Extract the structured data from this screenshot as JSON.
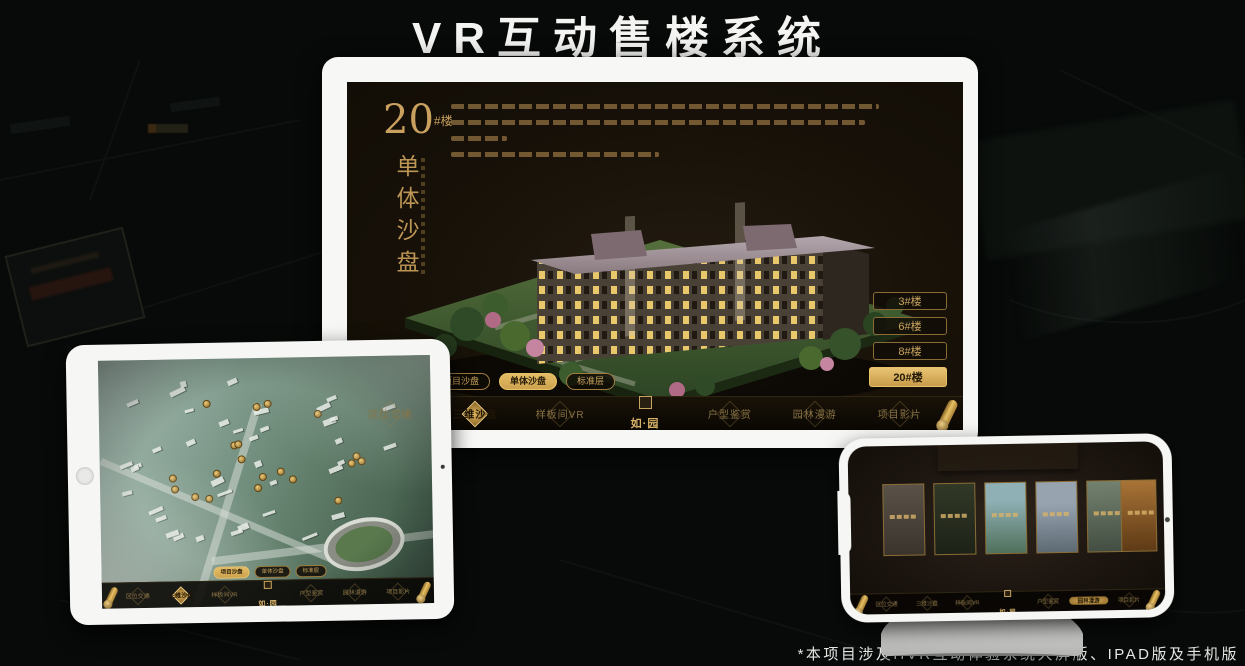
{
  "page": {
    "title": "VR互动售楼系统",
    "footnote": "*本项目涉及HVR互动体验系统大屏版、IPAD版及手机版"
  },
  "brand": {
    "name": "如·园"
  },
  "colors": {
    "gold": "#c9a45e",
    "gold_bright": "#e8c266",
    "screen_bg": "#171108",
    "device_shell": "#f6f6f4"
  },
  "desktop_screen": {
    "building_no": "20",
    "building_suffix": "#楼",
    "section_title": "单体沙盘",
    "floor_buttons": [
      {
        "label": "3#楼",
        "active": false
      },
      {
        "label": "6#楼",
        "active": false
      },
      {
        "label": "8#楼",
        "active": false
      },
      {
        "label": "20#楼",
        "active": true
      }
    ],
    "view_tabs": [
      {
        "label": "项目沙盘",
        "active": false
      },
      {
        "label": "单体沙盘",
        "active": true
      },
      {
        "label": "标准层",
        "active": false
      }
    ],
    "menu": [
      {
        "label": "区位交通",
        "active": false
      },
      {
        "label": "三维沙盘",
        "active": true
      },
      {
        "label": "样板间VR",
        "active": false
      },
      {
        "label": "户型鉴赏",
        "active": false
      },
      {
        "label": "园林漫游",
        "active": false
      },
      {
        "label": "项目影片",
        "active": false
      }
    ]
  },
  "tablet_screen": {
    "view_tabs": [
      {
        "label": "项目沙盘",
        "active": true
      },
      {
        "label": "单体沙盘",
        "active": false
      },
      {
        "label": "标准层",
        "active": false
      }
    ],
    "menu": [
      {
        "label": "区位交通",
        "active": false
      },
      {
        "label": "三维沙盘",
        "active": true
      },
      {
        "label": "样板间VR",
        "active": false
      },
      {
        "label": "户型鉴赏",
        "active": false
      },
      {
        "label": "园林漫游",
        "active": false
      },
      {
        "label": "项目影片",
        "active": false
      }
    ]
  },
  "phone_screen": {
    "menu": [
      {
        "label": "区位交通",
        "active": false
      },
      {
        "label": "三维沙盘",
        "active": false
      },
      {
        "label": "样板间VR",
        "active": false
      },
      {
        "label": "户型鉴赏",
        "active": false
      },
      {
        "label": "园林漫游",
        "active": true
      },
      {
        "label": "项目影片",
        "active": false
      }
    ]
  }
}
